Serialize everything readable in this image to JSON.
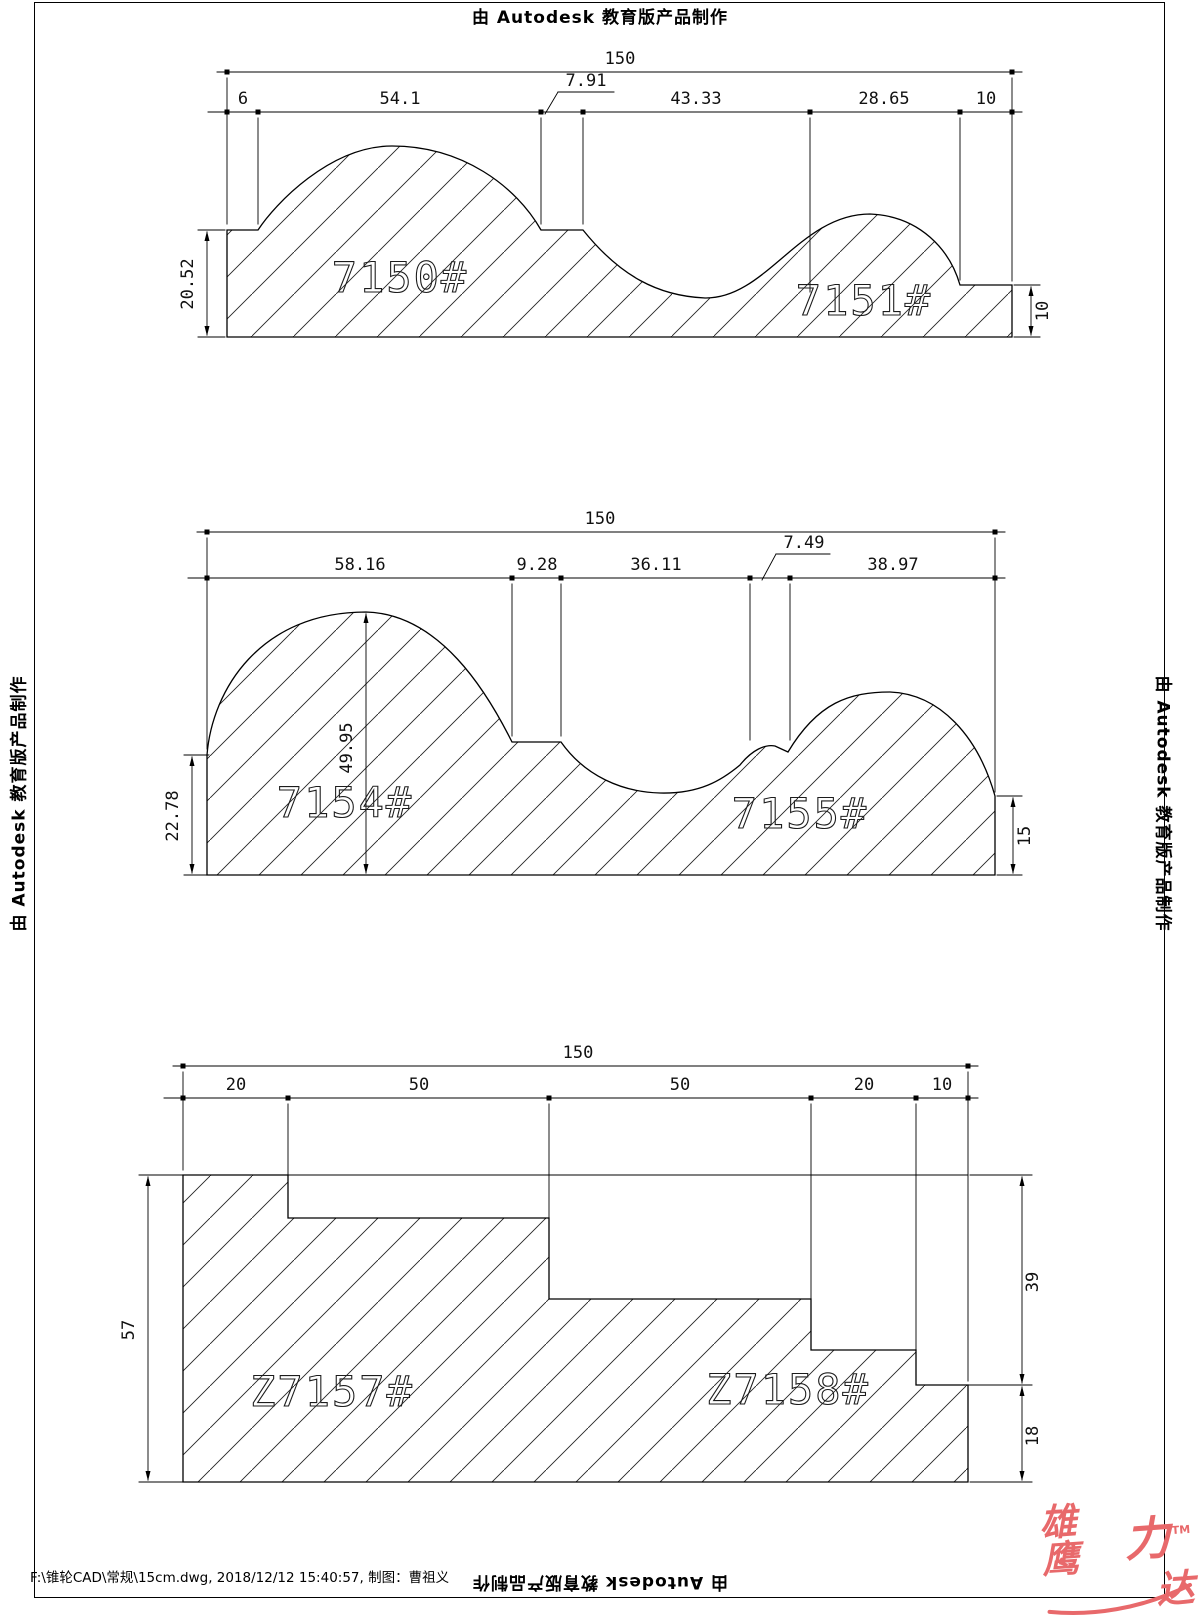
{
  "page": {
    "autodesk_notice": "由 Autodesk 教育版产品制作"
  },
  "footer": {
    "file_info": "F:\\锥轮CAD\\常规\\15cm.dwg, 2018/12/12 15:40:57, 制图：曹祖义"
  },
  "logo": {
    "chars": [
      "雄鹰",
      "力",
      "达"
    ],
    "tm": "TM",
    "color": "#e8696b"
  },
  "drawings": [
    {
      "id": "top-profile",
      "labels": [
        "7150#",
        "7151#"
      ],
      "dims": {
        "overall": "150",
        "segments": [
          "6",
          "54.1",
          "7.91",
          "43.33",
          "28.65",
          "10"
        ],
        "left_height": "20.52",
        "right_height": "10"
      }
    },
    {
      "id": "middle-profile",
      "labels": [
        "7154#",
        "7155#"
      ],
      "dims": {
        "overall": "150",
        "segments": [
          "58.16",
          "9.28",
          "36.11",
          "7.49",
          "38.97"
        ],
        "left_height": "22.78",
        "peak_height": "49.95",
        "right_height": "15"
      }
    },
    {
      "id": "bottom-profile",
      "labels": [
        "Z7157#",
        "Z7158#"
      ],
      "dims": {
        "overall": "150",
        "segments": [
          "20",
          "50",
          "50",
          "20",
          "10"
        ],
        "left_height": "57",
        "right_upper_height": "39",
        "right_lower_height": "18"
      }
    }
  ]
}
